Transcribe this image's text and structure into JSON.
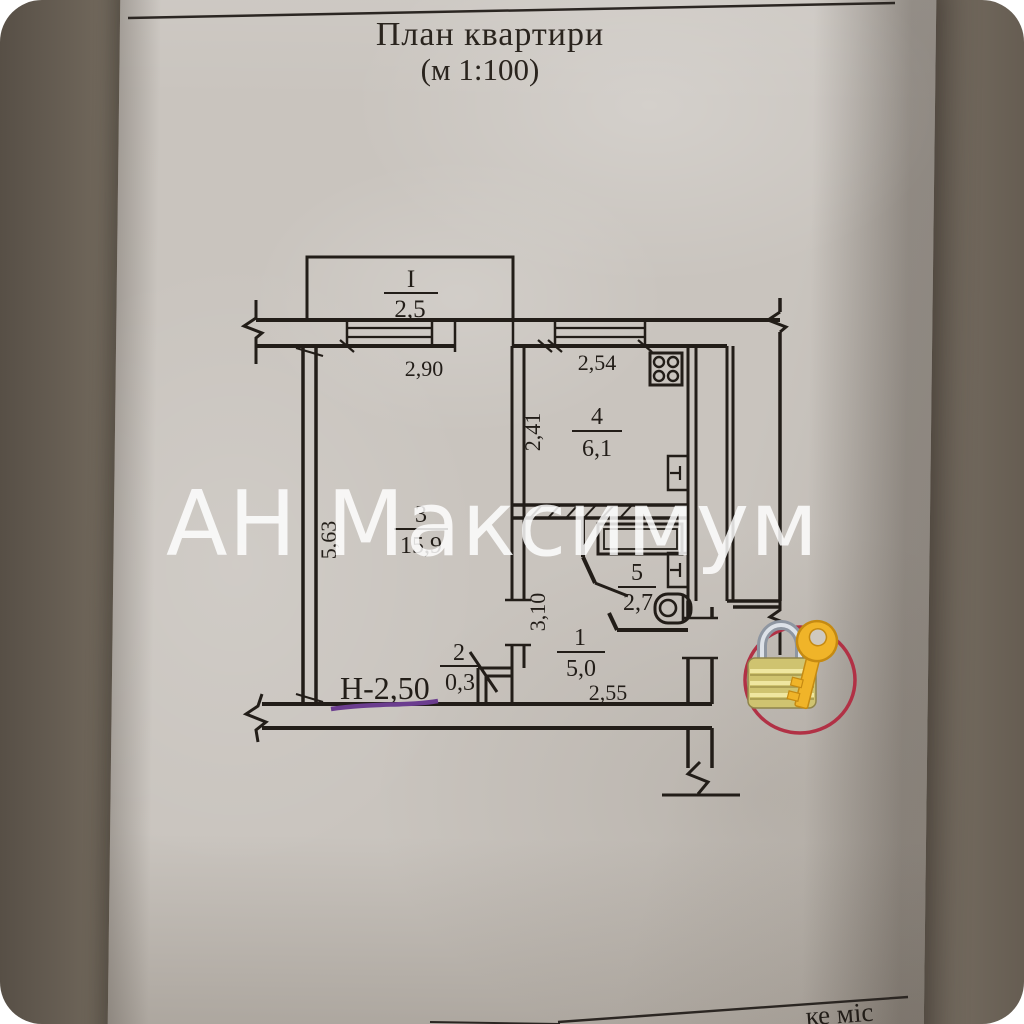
{
  "title": {
    "line1": "План квартири",
    "line2": "(м 1:100)"
  },
  "watermark": {
    "text": "АН Максимум",
    "color": "#ffffff"
  },
  "plan": {
    "height_note": "Н-2,50",
    "rooms": {
      "balcony": {
        "number": "I",
        "area": "2,5"
      },
      "living": {
        "number": "3",
        "area": "15,9"
      },
      "kitchen": {
        "number": "4",
        "area": "6,1"
      },
      "bathroom": {
        "number": "5",
        "area": "2,7"
      },
      "closet": {
        "number": "2",
        "area": "0,3"
      },
      "hallway": {
        "number": "1",
        "area": "5,0"
      }
    },
    "dimensions": {
      "living_window": "2,90",
      "kitchen_window": "2,54",
      "kitchen_depth": "2,41",
      "living_depth": "5,63",
      "hallway_depth": "3,10",
      "hallway_width": "2,55"
    },
    "icons": {
      "stove": "stove-icon",
      "bathtub": "bathtub-icon",
      "toilet": "toilet-icon",
      "radiator": "radiator-icon"
    }
  },
  "sticker": {
    "icon": "padlock-with-key-icon",
    "circle_color": "#b13145",
    "lock_body_color": "#d6ca79",
    "shackle_color": "#a7afb9",
    "key_color": "#f0b429"
  },
  "footer": {
    "partial_text": "ке міс"
  },
  "colors": {
    "paper": "#c9c4be",
    "ink": "#221d18",
    "underline": "#6b3d8f",
    "background": "#7b7166"
  }
}
